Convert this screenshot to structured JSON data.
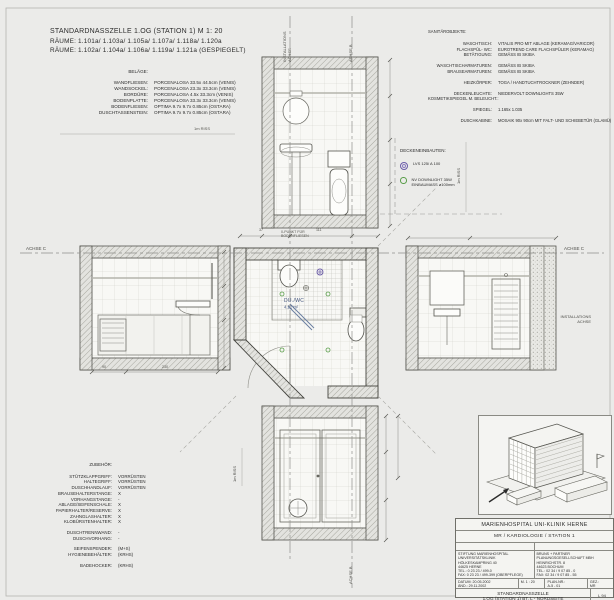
{
  "top_titles": {
    "line1": "STANDARDNASSZELLE 1.OG (STATION 1)  M 1: 20",
    "line2": "RÄUME: 1.101a/ 1.103a/ 1.105a/ 1.107a/ 1.118a/ 1.120a",
    "line3": "RÄUME: 1.102a/ 1.104a/ 1.106a/ 1.119a/ 1.121a (GESPIEGELT)"
  },
  "belaege": {
    "heading": "BELÄGE:",
    "rows": [
      {
        "label": "WANDFLIESEN:",
        "value": "PORCENALOSA 33.5x 44.5cm (VENIS)"
      },
      {
        "label": "WANDSOCKEL:",
        "value": "PORCENALOSA 23.3x 33.3cm (VENIS)"
      },
      {
        "label": "BORDÜRE:",
        "value": "PORCENALOSA 4.5x 33.3cm (VENIS)"
      },
      {
        "label": "BODENPLATTE:",
        "value": "PORCENALOSA 33.3x 33.3cm (VENIS)"
      },
      {
        "label": "BODENFLIESEN:",
        "value": "OPTIMA 9.7x 9.7x 0.85cm (OSTARA)"
      },
      {
        "label": "DUSCHTASSENSTEIN:",
        "value": "OPTIMA 9.7x 9.7x 0.85cm (OSTARA)"
      }
    ]
  },
  "sanitaer": {
    "heading": "SANITÄROBJEKTE:",
    "rows": [
      {
        "label": "WASCHTISCH:",
        "value": "VITALIS PRO MIT ABLAGE (KERAMAG/VARICOR)"
      },
      {
        "label": "FLACHSPÜL- WC:",
        "value": "EUROTREND CARE FLACHSPÜLER (KERAMAG)"
      },
      {
        "label": "BETÄTIGUNG:",
        "value": "GEMÄSS IB SKIBA"
      },
      {
        "label": "WASCHTISCHARMATUREN:",
        "value": "GEMÄSS IB SKIBA"
      },
      {
        "label": "BRAUSEARMATUREN:",
        "value": "GEMÄSS IB SKIBA"
      },
      {
        "label": "HEIZKÖRPER:",
        "value": "TOGA / HANDTUCHTROCKNER (ZEHNDER)"
      },
      {
        "label": "DECKENLEUCHTE:",
        "value": "NIEDERVOLT DOWNLIGHTS 35W"
      },
      {
        "label": "KOSMETIKSPIEGEL M. BELEUCHT.:",
        "value": ""
      },
      {
        "label": "SPIEGEL:",
        "value": "1.165x 1.035"
      },
      {
        "label": "DUSCHKABINE:",
        "value": "MOSAIK 90x 90cm MIT FALT- UND SCHIEBETÜR (GLAMÜ)"
      }
    ]
  },
  "deckeneinbauten": {
    "heading": "DECKENEINBAUTEN:",
    "item1": "LVS 125/ A 100",
    "item2_l1": "NV DOWNLIGHT 35W",
    "item2_l2": "EINBAUMASS ø100mm"
  },
  "zubehoer": {
    "heading": "ZUBEHÖR:",
    "rows": [
      {
        "label": "STÜTZKLAPPGRIFF:",
        "value": "VORRÜSTEN"
      },
      {
        "label": "HALTEGRIFF:",
        "value": "VORRÜSTEN"
      },
      {
        "label": "DUSCHHANDLAUF:",
        "value": "VORRÜSTEN"
      },
      {
        "label": "BRAUSEHALTERSTANGE:",
        "value": "X"
      },
      {
        "label": "VORHANGSTANGE:",
        "value": "-"
      },
      {
        "label": "ABLAGE/SEIFENSCHALE:",
        "value": "X"
      },
      {
        "label": "PAPIERHALTER/RESERVE:",
        "value": "X"
      },
      {
        "label": "ZAHNGLASHALTER:",
        "value": "X"
      },
      {
        "label": "KLOBÜRSTENHALTER:",
        "value": "X"
      },
      {
        "label": "DUSCHTRENNWAND:",
        "value": "-"
      },
      {
        "label": "DUSCHVORHANG:",
        "value": "-"
      },
      {
        "label": "SEIFENSPENDER:",
        "value": "(M+S)"
      },
      {
        "label": "HYGIENEBEHÄLTER:",
        "value": "(KRHS)"
      },
      {
        "label": "BADEHOCKER:",
        "value": "(KRHS)"
      }
    ]
  },
  "axes": {
    "achse_c": "ACHSE C",
    "achse_b": "ACHSE B",
    "installations": "INSTALLATIONS",
    "achse": "ACHSE",
    "riss_1m": "1m RISS"
  },
  "plan": {
    "room": "DU./WC",
    "area": "4.22 m²",
    "zero1": "0-PUNKT FÜR",
    "zero2": "BODENFLIESEN"
  },
  "dims": {
    "a": "37",
    "b": "111",
    "c": "90",
    "d": "230"
  },
  "colors": {
    "lvs": "#6b5ca8",
    "downlight": "#5a9e4a",
    "room_label": "#44567f"
  },
  "titleblock": {
    "hospital": "MARIENHOSPITAL UNI-KLINIK HERNE",
    "department": "MR / KARDIOLOGIE / STATION 1",
    "bauherr_label": "BAUHERR:",
    "architekten_label": "ARCHITEKTEN:",
    "bauherr_lines": {
      "l1": "STIFTUNG MARIENHOSPITAL",
      "l2": "UNIVERSITÄTSKLINIK",
      "l3": "HÖLKESKAMPRING 40",
      "l4": "44625 HERNE",
      "l5": "TEL.: 0 23 23 / 499-0",
      "l6": "FAX: 0 23 23 / 499-399 (OBERPFLEGE)"
    },
    "architekt_lines": {
      "l1": "BRUNS + PARTNER",
      "l2": "PLANUNGSGESELLSCHAFT MBH",
      "l3": "HEINRICHSTR. 8",
      "l4": "44623 BOCHUM",
      "l5": "TEL.: 02 34 / 9 07 85 - 0",
      "l6": "FAX: 02 34 / 9 07 85 - 55"
    },
    "meta": {
      "c1l1": "DATUM: 20.05.2002",
      "c1l2": "ÄND.: 29.11.2002",
      "c2l1": "M. 1 : 20",
      "c3l1": "PLAN-NR.:",
      "c3l2": "A-5 - 01",
      "c4l1": "GEZ.:",
      "c4l2": "MR"
    },
    "plan_title1": "STANDARDNASSZELLE",
    "plan_title2": "1.OG (STATION 1) BT. L - NORDSEITE",
    "sheet_no": "L 94"
  }
}
